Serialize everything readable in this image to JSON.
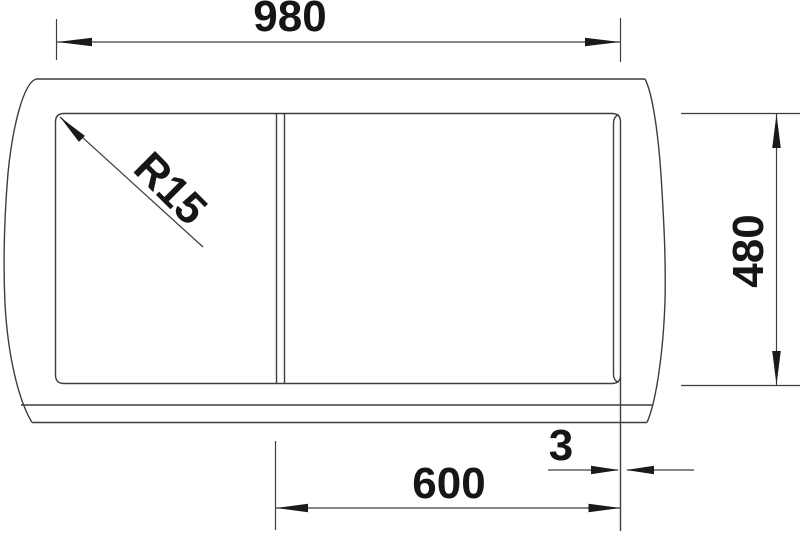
{
  "drawing": {
    "kind": "technical-dimension-drawing",
    "subject": "sink top view with drainer, broken-out side edges",
    "background_color": "#ffffff",
    "line_color": "#3d3d3d",
    "text_color": "#161616",
    "dimensions": {
      "width": {
        "label": "980"
      },
      "depth": {
        "label": "480"
      },
      "offset": {
        "label": "600"
      },
      "gap": {
        "label": "3"
      },
      "radius": {
        "label": "R15"
      }
    }
  }
}
